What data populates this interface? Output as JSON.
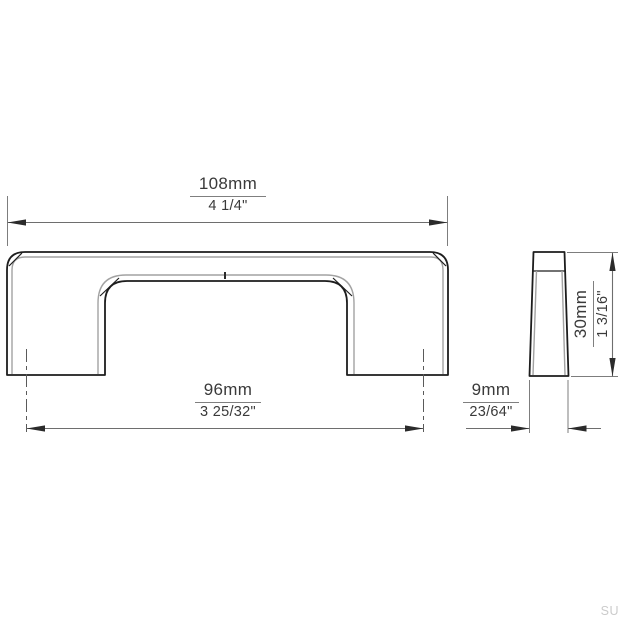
{
  "drawing": {
    "type": "technical-drawing",
    "subject": "cabinet-handle-two-views",
    "dims": {
      "overall_width": {
        "mm": "108mm",
        "inch": "4 1/4\""
      },
      "hole_spacing": {
        "mm": "96mm",
        "inch": "3 25/32\""
      },
      "height": {
        "mm": "30mm",
        "inch": "1 3/16\""
      },
      "depth": {
        "mm": "9mm",
        "inch": "23/64\""
      }
    },
    "colors": {
      "background": "#ffffff",
      "outline": "#1d1d1d",
      "secondary_contour": "#a2a2a2",
      "dimension_lines": "#6e6e6e",
      "text": "#3a3a3a",
      "watermark": "#cbcbcb"
    }
  },
  "watermark": "SU"
}
